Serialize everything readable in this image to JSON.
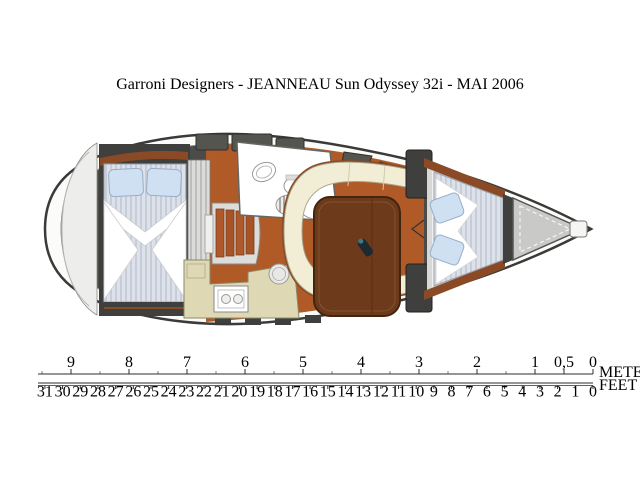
{
  "title": "Garroni Designers   -   JEANNEAU Sun Odyssey 32i   -   MAI 2006",
  "scale": {
    "meters_label": "METERS",
    "feet_label": "FEET",
    "meters_ticks": [
      {
        "v": 9,
        "t": "9"
      },
      {
        "v": 8,
        "t": "8"
      },
      {
        "v": 7,
        "t": "7"
      },
      {
        "v": 6,
        "t": "6"
      },
      {
        "v": 5,
        "t": "5"
      },
      {
        "v": 4,
        "t": "4"
      },
      {
        "v": 3,
        "t": "3"
      },
      {
        "v": 2,
        "t": "2"
      },
      {
        "v": 1,
        "t": "1"
      },
      {
        "v": 0.5,
        "t": "0,5"
      },
      {
        "v": 0,
        "t": "0"
      }
    ],
    "feet_ticks": [
      31,
      30,
      29,
      28,
      27,
      26,
      25,
      24,
      23,
      22,
      21,
      20,
      19,
      18,
      17,
      16,
      15,
      14,
      13,
      12,
      11,
      10,
      9,
      8,
      7,
      6,
      5,
      4,
      3,
      2,
      1,
      0
    ]
  },
  "colors": {
    "hull_outline": "#3a3a38",
    "interior_dark": "#4b4b49",
    "wood_floor": "#b05a28",
    "wood_trim": "#8a4a26",
    "settee": "#f2eed6",
    "table": "#6e3a1c",
    "galley_counter": "#ded9b4",
    "pillow": "#cfe0f2",
    "linen": "#ffffff",
    "bow_locker": "#c9c9c7",
    "stern_cap": "#ededeb"
  }
}
